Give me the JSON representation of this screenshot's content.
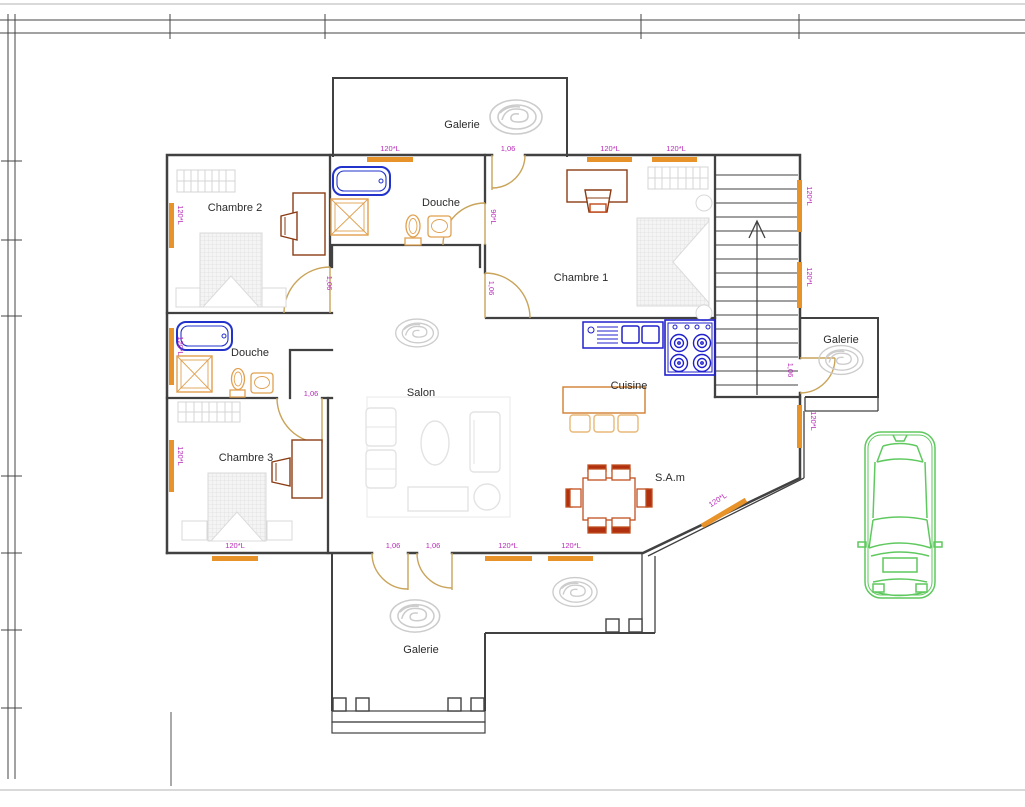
{
  "drawing": {
    "type": "floor-plan",
    "floor": "architectural plan with staircase, three bedrooms, two bathrooms, living areas and galleries"
  },
  "rooms": {
    "galerie_top": "Galerie",
    "douche_top": "Douche",
    "chambre2": "Chambre 2",
    "chambre1": "Chambre 1",
    "galerie_right": "Galerie",
    "douche_left": "Douche",
    "salon": "Salon",
    "cuisine": "Cuisine",
    "chambre3": "Chambre 3",
    "sam": "S.A.m",
    "galerie_bottom": "Galerie"
  },
  "dims": {
    "window_120": "120*L",
    "door_106": "1,06",
    "door_90": "90*L"
  },
  "colors": {
    "wall": "#414141",
    "window": "#e8922a",
    "door": "#c9a45a",
    "dimension_label": "#b82ab8",
    "fixture_blue": "#2233cc",
    "kitchen_blue": "#2020cc",
    "fixture_orange": "#e0a050",
    "furniture_dark": "#8b3c14",
    "dining_red": "#b03010",
    "furniture_light": "#dcdcdc",
    "decor_gray": "#cccccc",
    "car_green": "#5fc95f",
    "ruler": "#444444",
    "margin_line": "#d9d9d9"
  }
}
